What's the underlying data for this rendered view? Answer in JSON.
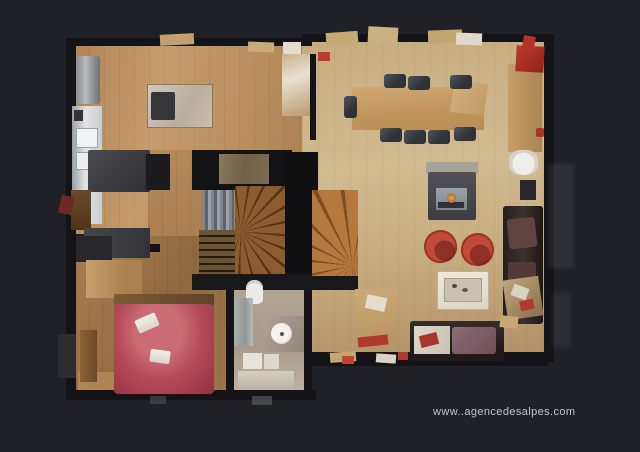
{
  "watermark": {
    "text": "www..agencedesalpes.com"
  },
  "scene": {
    "title": "3D top-down dollhouse floor plan of a chalet apartment",
    "rooms": [
      {
        "name": "kitchen",
        "position": "top-left"
      },
      {
        "name": "dining-area",
        "position": "top-right"
      },
      {
        "name": "living-room",
        "position": "right"
      },
      {
        "name": "staircase-hall",
        "position": "center"
      },
      {
        "name": "bedroom",
        "position": "bottom-left"
      },
      {
        "name": "bathroom",
        "position": "bottom-center"
      }
    ],
    "furniture": [
      "fridge",
      "kitchen-counter-sink",
      "kitchen-island-cooktop",
      "dark-tables",
      "long-dining-table",
      "eight-dark-chairs",
      "wood-stove-fireplace",
      "two-red-tub-armchairs",
      "small-red-chair",
      "cream-coffee-table",
      "dark-leather-corner-sofa",
      "wood-side-table",
      "sideboard",
      "red-cabinet",
      "white-armchair",
      "winder-staircase",
      "double-bed-red-cover",
      "folded-white-towels",
      "wardrobe",
      "toilet",
      "shower",
      "round-basin-vanity",
      "bath-steps"
    ]
  },
  "palette": {
    "background": "#1f2126",
    "walls": "#141418",
    "wood_light": "#d2bb92",
    "wood_mid": "#b98f60",
    "wood_dark": "#8f6a40",
    "stair_wood": "#b5793f",
    "accent_red": "#c04434",
    "bed_red": "#b54a58",
    "fixture_white": "#ecebe7",
    "watermark_text": "#c3c4c8"
  }
}
